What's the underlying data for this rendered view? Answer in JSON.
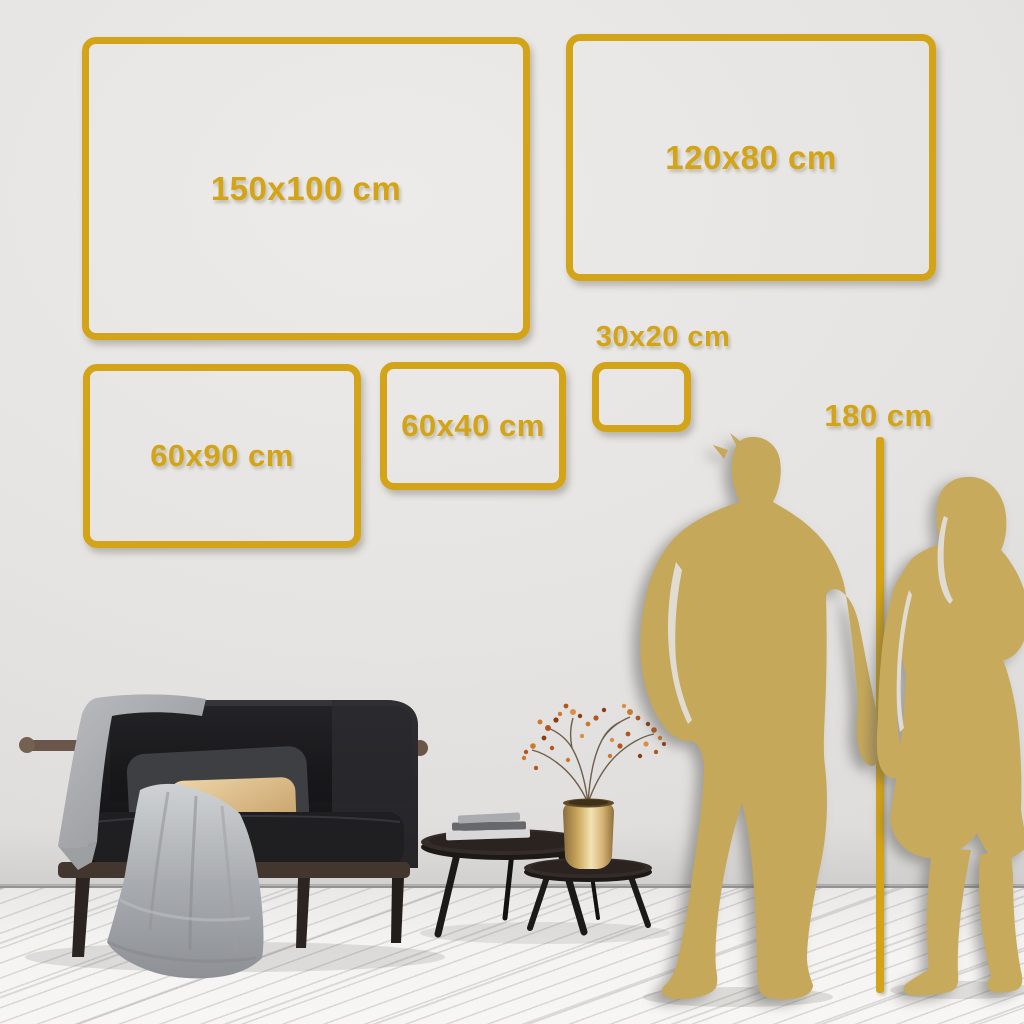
{
  "colors": {
    "frame_gold": "#d3a417",
    "silhouette_gold": "#c6a85a",
    "wall": "#e6e4e2",
    "floor": "#f4f3f2"
  },
  "size_boxes": [
    {
      "label": "150x100 cm"
    },
    {
      "label": "120x80 cm"
    },
    {
      "label": "60x90 cm"
    },
    {
      "label": "60x40 cm"
    },
    {
      "label": "30x20 cm"
    }
  ],
  "height_marker": {
    "label": "180 cm"
  }
}
